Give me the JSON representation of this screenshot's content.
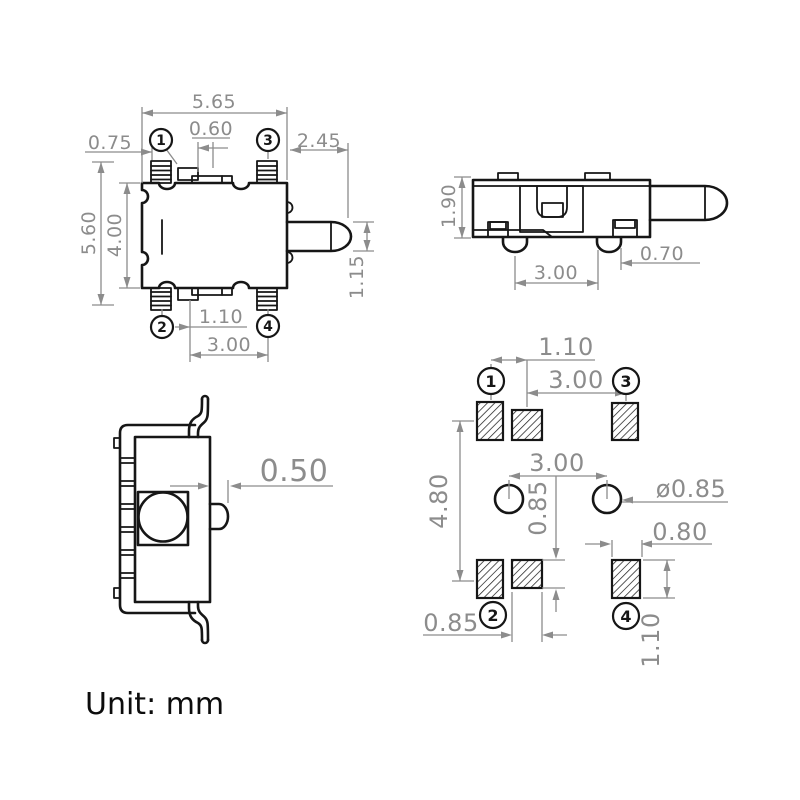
{
  "unit_label": "Unit: mm",
  "colors": {
    "outline": "#161616",
    "dimension": "#8c8c8c",
    "background": "#ffffff"
  },
  "top_view": {
    "dims": {
      "overall_width": "5.65",
      "pin_offset": "0.75",
      "center_tab_width": "0.60",
      "plunger_length": "2.45",
      "overall_height": "5.60",
      "body_height": "4.00",
      "plunger_height": "1.15",
      "pin_tab_offset": "1.10",
      "pin_span": "3.00"
    },
    "pins": {
      "p1": "1",
      "p2": "2",
      "p3": "3",
      "p4": "4"
    }
  },
  "side_view": {
    "dims": {
      "body_height": "1.90",
      "foot_span": "3.00",
      "foot_width": "0.70"
    }
  },
  "front_view": {
    "dims": {
      "tab_gap": "0.50"
    }
  },
  "land_pattern": {
    "dims": {
      "pad_center_offset": "1.10",
      "pad_center_span": "3.00",
      "pad_row_pitch": "4.80",
      "hole_span": "3.00",
      "center_pad_height": "0.85",
      "hole_diameter": "ø0.85",
      "corner_pad_width": "0.80",
      "center_pad_width": "0.85",
      "corner_pad_height": "1.10"
    },
    "pins": {
      "p1": "1",
      "p2": "2",
      "p3": "3",
      "p4": "4"
    }
  }
}
